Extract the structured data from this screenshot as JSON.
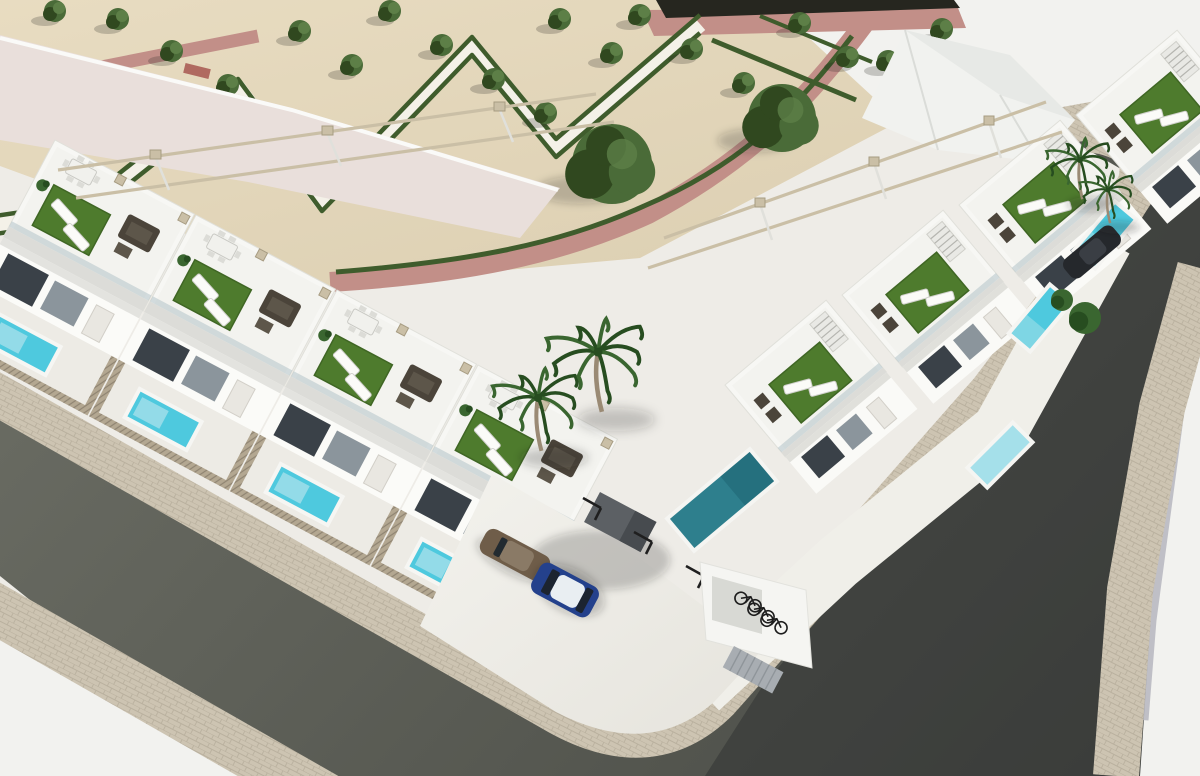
{
  "meta": {
    "type": "aerial-3d-architectural-render",
    "title": "Modern white townhouse development on a street corner",
    "description": "Aerial render: two rows of white modern townhouses with rooftop terraces (artificial turf, sun loungers, rattan lounge sets, pergola rails), private plunge pools behind slatted fences, a sand-coloured plaza with a formal hedge park, asphalt streets with cobbled sidewalks, a parking court with cars and a bicycle niche, and palm trees."
  },
  "inventory": {
    "townhouse_units_left_row": 4,
    "townhouse_units_right_row": 4,
    "parked_cars": 3,
    "bicycles": 3,
    "private_pools": 8,
    "palm_trees": 4,
    "park_small_trees": 21,
    "park_large_trees": 2
  },
  "colors": {
    "base": "#eeece7",
    "sand": "#e8dcc1",
    "sand_deep": "#ddd0b3",
    "bright": "#f2f2ef",
    "park_white_path": "#f4f1e8",
    "rose_path": "#c28f88",
    "hedge": "#3f5c2c",
    "tree": "#4a6b38",
    "tree_dark": "#30481f",
    "tree_light": "#5d7f47",
    "turf": "#4e7b2d",
    "turf_dark": "#3f6624",
    "building_white": "#f7f7f4",
    "building_floor": "#f3f3ef",
    "building_shade": "#dcdcd8",
    "big_roof": "#e9dfdb",
    "glass": "#3a4148",
    "glass_light": "#8b959c",
    "balustrade": "#aebfc6",
    "pergola": "#cabfa6",
    "pergola_dark": "#a79c82",
    "fence": "#b3a791",
    "fence_line": "#8f8472",
    "asphalt_light": "#6b6d64",
    "asphalt_dark": "#4a4c46",
    "road_b_shadow": "#26282a",
    "cobble": "#cdc4b2",
    "cobble_line": "#b9b09e",
    "pavement_white": "#f2f2ef",
    "stripe_gray": "#b6b6be",
    "pool_cyan": "#4ec9de",
    "pool_light": "#a5e0ea",
    "pool_teal": "#2e7f8d",
    "pool_deep": "#1f6575",
    "car_blue": "#24418c",
    "car_roof_white": "#e9eef2",
    "car_brown": "#6f5d49",
    "car_brown_roof": "#8a7a66",
    "car_dark": "#25282c",
    "bike": "#1d1d1d",
    "rattan": "#4b443a",
    "rattan_light": "#5d564a",
    "white_furniture": "#fbfbf8",
    "palm": "#3a6630",
    "palm_dark": "#274d20",
    "trunk": "#9a8a74",
    "door_gray": "#a8adb2",
    "ramp_gray": "#5c6064",
    "black_band": "#26261f",
    "shadow": "rgba(30,30,28,0.22)"
  },
  "park": {
    "small_trees": [
      [
        55,
        14
      ],
      [
        118,
        22
      ],
      [
        172,
        54
      ],
      [
        228,
        88
      ],
      [
        284,
        122
      ],
      [
        338,
        155
      ],
      [
        390,
        14
      ],
      [
        442,
        48
      ],
      [
        494,
        82
      ],
      [
        546,
        116
      ],
      [
        300,
        34
      ],
      [
        352,
        68
      ],
      [
        560,
        22
      ],
      [
        612,
        56
      ],
      [
        640,
        18
      ],
      [
        692,
        52
      ],
      [
        744,
        86
      ],
      [
        800,
        26
      ],
      [
        848,
        60
      ],
      [
        888,
        64
      ],
      [
        942,
        32
      ]
    ],
    "large_trees": [
      [
        612,
        168,
        40
      ],
      [
        782,
        122,
        34
      ]
    ]
  },
  "plants": {
    "palms": [
      [
        538,
        398,
        1.15
      ],
      [
        598,
        352,
        1.3
      ],
      [
        1080,
        160,
        0.85
      ],
      [
        1108,
        190,
        0.72
      ]
    ],
    "shrubs": [
      [
        1085,
        318,
        16
      ],
      [
        1062,
        300,
        11
      ]
    ]
  },
  "courtyard": {
    "bicycles": [
      [
        748,
        602
      ],
      [
        761,
        613
      ],
      [
        774,
        624
      ]
    ],
    "bay_markers": [
      [
        583,
        498
      ],
      [
        634,
        532
      ],
      [
        686,
        566
      ]
    ]
  },
  "pools_right": [
    [
      1040,
      318,
      -50
    ],
    [
      1000,
      455,
      -45
    ],
    [
      1105,
      235,
      -50
    ]
  ],
  "pool_teal_pos": [
    722,
    500,
    -40
  ]
}
